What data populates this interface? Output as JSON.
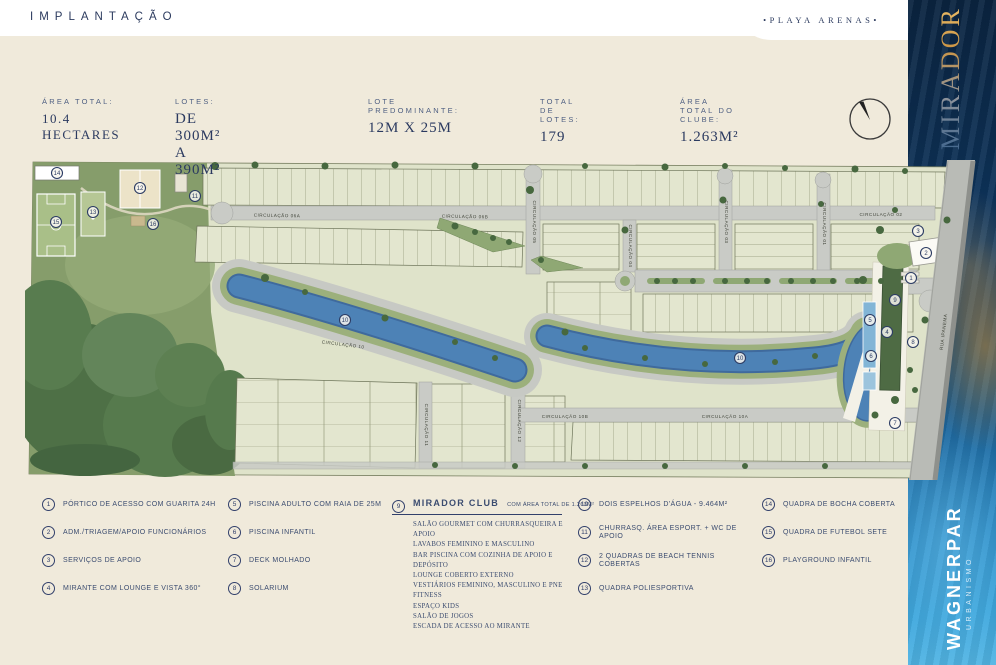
{
  "header": {
    "title": "IMPLANTAÇÃO",
    "badge": "•PLAYA ARENAS•"
  },
  "side_band": {
    "brand": "MIRADOR",
    "developer": "WAGNERPAR",
    "developer_tagline": "URBANISMO"
  },
  "stats": [
    {
      "label": "ÁREA TOTAL:",
      "value": "10.4 HECTARES"
    },
    {
      "label": "LOTES:",
      "value": "DE 300M² A 390M²"
    },
    {
      "label": "LOTE PREDOMINANTE:",
      "value": "12M X 25M"
    },
    {
      "label": "TOTAL DE LOTES:",
      "value": "179"
    },
    {
      "label": "ÁREA TOTAL DO CLUBE:",
      "value": "1.263M²"
    }
  ],
  "map": {
    "road_labels": [
      {
        "text": "CIRCULAÇÃO 06A",
        "x": 252,
        "y": 57,
        "angle": 1
      },
      {
        "text": "CIRCULAÇÃO 06B",
        "x": 440,
        "y": 58,
        "angle": 1
      },
      {
        "text": "CIRCULAÇÃO 02",
        "x": 856,
        "y": 56,
        "angle": 0
      },
      {
        "text": "CIRCULAÇÃO 05",
        "x": 508,
        "y": 62,
        "angle": 90
      },
      {
        "text": "CIRCULAÇÃO 04",
        "x": 604,
        "y": 86,
        "angle": 90
      },
      {
        "text": "CIRCULAÇÃO 03",
        "x": 700,
        "y": 62,
        "angle": 90
      },
      {
        "text": "CIRCULAÇÃO 01",
        "x": 798,
        "y": 64,
        "angle": 90
      },
      {
        "text": "CIRCULAÇÃO 10",
        "x": 318,
        "y": 186,
        "angle": 7
      },
      {
        "text": "CIRCULAÇÃO 10B",
        "x": 540,
        "y": 258,
        "angle": 0
      },
      {
        "text": "CIRCULAÇÃO 10A",
        "x": 700,
        "y": 258,
        "angle": 0
      },
      {
        "text": "CIRCULAÇÃO 11",
        "x": 400,
        "y": 265,
        "angle": 90
      },
      {
        "text": "CIRCULAÇÃO 12",
        "x": 493,
        "y": 261,
        "angle": 90
      },
      {
        "text": "RUA IPANEMA",
        "x": 920,
        "y": 172,
        "angle": -83
      }
    ],
    "markers": [
      {
        "n": "14",
        "x": 32,
        "y": 13
      },
      {
        "n": "15",
        "x": 31,
        "y": 62
      },
      {
        "n": "13",
        "x": 68,
        "y": 52
      },
      {
        "n": "12",
        "x": 115,
        "y": 28
      },
      {
        "n": "16",
        "x": 128,
        "y": 64
      },
      {
        "n": "11",
        "x": 170,
        "y": 36
      },
      {
        "n": "10",
        "x": 320,
        "y": 160
      },
      {
        "n": "10",
        "x": 715,
        "y": 198
      },
      {
        "n": "3",
        "x": 893,
        "y": 71
      },
      {
        "n": "2",
        "x": 901,
        "y": 93
      },
      {
        "n": "1",
        "x": 886,
        "y": 118
      },
      {
        "n": "9",
        "x": 870,
        "y": 140
      },
      {
        "n": "5",
        "x": 845,
        "y": 160
      },
      {
        "n": "4",
        "x": 862,
        "y": 172
      },
      {
        "n": "6",
        "x": 846,
        "y": 196
      },
      {
        "n": "8",
        "x": 888,
        "y": 182
      },
      {
        "n": "7",
        "x": 870,
        "y": 263
      }
    ]
  },
  "legend": {
    "col1": [
      {
        "num": "1",
        "text": "PÓRTICO DE ACESSO COM GUARITA 24H"
      },
      {
        "num": "2",
        "text": "ADM./TRIAGEM/APOIO FUNCIONÁRIOS"
      },
      {
        "num": "3",
        "text": "SERVIÇOS DE APOIO"
      },
      {
        "num": "4",
        "text": "MIRANTE COM LOUNGE E VISTA 360°"
      }
    ],
    "col2": [
      {
        "num": "5",
        "text": "PISCINA ADULTO COM RAIA DE 25M"
      },
      {
        "num": "6",
        "text": "PISCINA INFANTIL"
      },
      {
        "num": "7",
        "text": "DECK MOLHADO"
      },
      {
        "num": "8",
        "text": "SOLARIUM"
      }
    ],
    "club": {
      "num": "9",
      "title": "MIRADOR CLUB",
      "subtitle": "COM ÁREA TOTAL DE 1.263M²",
      "features": [
        "SALÃO GOURMET COM CHURRASQUEIRA E APOIO",
        "LAVABOS FEMININO E MASCULINO",
        "BAR PISCINA COM COZINHA DE APOIO E DEPÓSITO",
        "LOUNGE COBERTO EXTERNO",
        "VESTIÁRIOS FEMININO, MASCULINO E PNE",
        "FITNESS",
        "ESPAÇO KIDS",
        "SALÃO DE JOGOS",
        "ESCADA DE ACESSO AO MIRANTE"
      ]
    },
    "col4": [
      {
        "num": "10",
        "text": "DOIS ESPELHOS D'ÁGUA - 9.464M²"
      },
      {
        "num": "11",
        "text": "CHURRASQ. ÁREA ESPORT. + WC DE APOIO"
      },
      {
        "num": "12",
        "text": "2 QUADRAS DE BEACH TENNIS COBERTAS"
      },
      {
        "num": "13",
        "text": "QUADRA POLIESPORTIVA"
      }
    ],
    "col5": [
      {
        "num": "14",
        "text": "QUADRA DE BOCHA COBERTA"
      },
      {
        "num": "15",
        "text": "QUADRA DE FUTEBOL SETE"
      },
      {
        "num": "16",
        "text": "PLAYGROUND INFANTIL"
      }
    ]
  },
  "colors": {
    "cream": "#f0eadb",
    "navy": "#2c3c63",
    "band_top": "#0b2440",
    "band_bottom": "#52b5e4",
    "gold": "#d9a14e",
    "water": "#4d82b6",
    "park_green": "#869d6b",
    "road_gray": "#c9cbc6"
  }
}
